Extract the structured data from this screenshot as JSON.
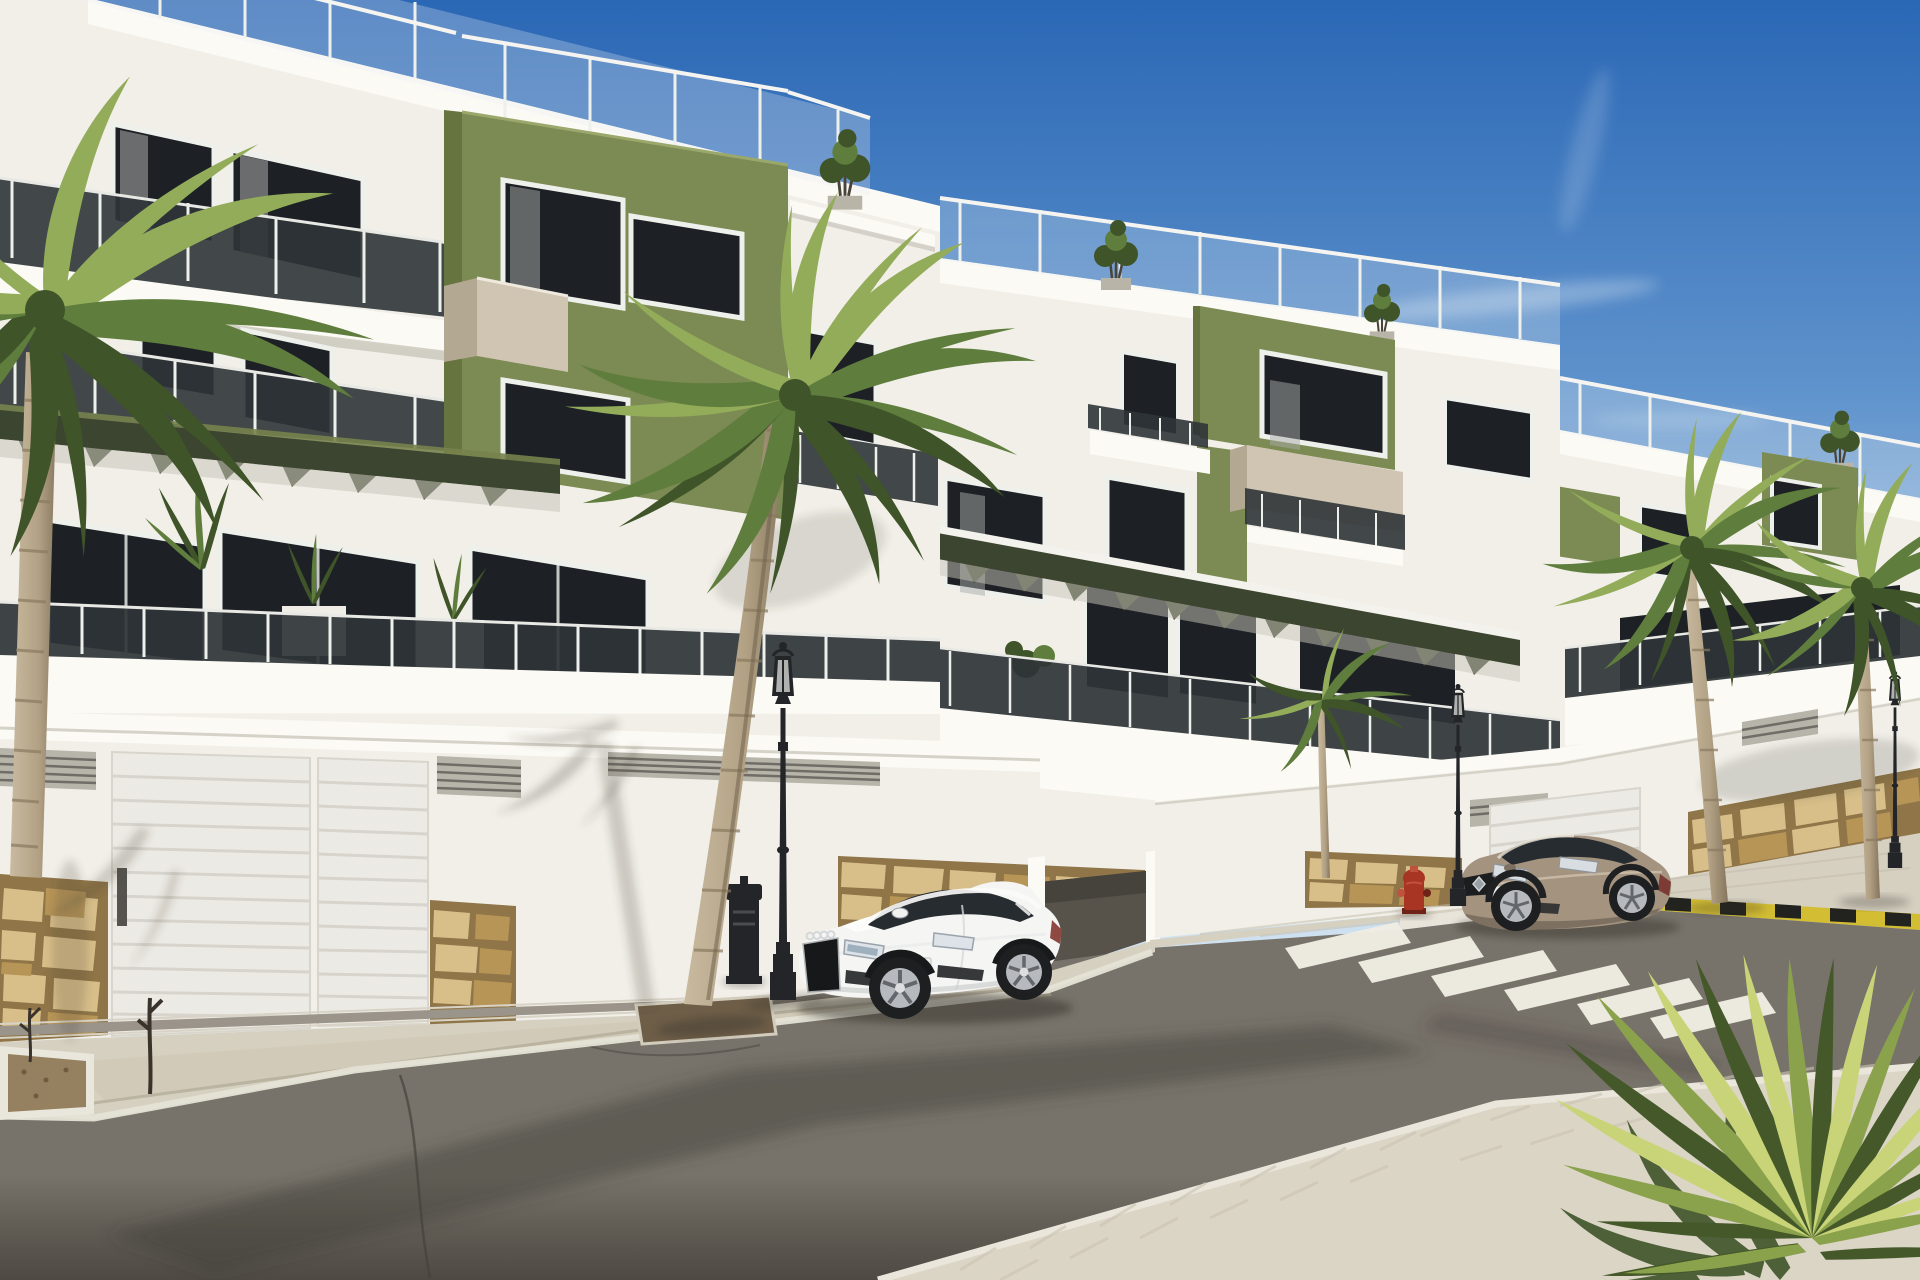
{
  "scene": {
    "type": "photorealistic-architectural-render",
    "description": "Modern white three-storey apartment complex with olive-green accent panels, smoked-glass balconies and roof terraces above a garage level; street in front with parked white coupe, bronze coupe at a zebra crossing, palm trees, classic street lamps and a foreground palmetto",
    "time_of_day": "sunny daytime, clear blue sky",
    "visible_text": "none legible (license plates blurred)"
  },
  "palette": {
    "sky_top": "#2a67b5",
    "sky_mid": "#6f9fd2",
    "sky_horizon": "#d9e8f4",
    "wall_white": "#f1efe8",
    "wall_bright": "#fbfaf5",
    "wall_shade": "#ddd9cf",
    "cornice_shadow": "#c9c5ba",
    "accent_olive": "#7c8a53",
    "accent_olive_dark": "#66743f",
    "accent_olive_light": "#8d9a60",
    "pergola_dark": "#3c452f",
    "pergola_slat": "#77824d",
    "glass_dark": "#1d2125",
    "glass_smoke": "#2f3437",
    "frame_white": "#eef0ec",
    "beige_box": "#cfc5b2",
    "beige_shade": "#b3a892",
    "stone_base": "#8f7547",
    "stone_light": "#d8bf8a",
    "stone_mid": "#b79557",
    "pave_light": "#d6d0c1",
    "pave_shade": "#c9bfa9",
    "curb_light": "#e5e1d6",
    "road_top": "#78736a",
    "road_bottom": "#4e4a43",
    "lamp_black": "#232528",
    "car_white": "#f5f5f3",
    "car_glass": "#272c31",
    "alloy_silver": "#b6babe",
    "renault_bronze": "#a3937f",
    "renault_shade": "#7e7060",
    "hydrant_red": "#a83524",
    "palm_green": "#5f7d3c",
    "palm_green_light": "#93ac5a",
    "palm_green_dark": "#3f5429",
    "trunk_light": "#c0b091",
    "yucca_light": "#c9d478",
    "yucca_mid": "#8ba24c",
    "yucca_dark": "#44582a",
    "hazard_yellow": "#d3bd33",
    "hazard_black": "#22231e"
  },
  "objects": {
    "buildings": [
      {
        "label": "left apartment block, 3 floors over garage, olive accent box, glass balustrades, roof terrace"
      },
      {
        "label": "middle apartment block, olive accent panels, beige balcony boxes, slatted pergola"
      },
      {
        "label": "right apartment block receding with olive panels and roof terrace"
      }
    ],
    "vehicles": [
      {
        "label": "white sports coupe parked at kerb",
        "color": "#f5f5f3"
      },
      {
        "label": "bronze coupe stopped by zebra crossing",
        "color": "#a3937f"
      }
    ],
    "street": {
      "crosswalk_stripes": 6,
      "hazard_curb": "yellow-black striped kerb on right median",
      "surfaces": [
        "asphalt road",
        "paved sidewalks",
        "stone-clad wall bases"
      ]
    },
    "furniture": {
      "street_lamps": 3,
      "litter_bin": 1,
      "fire_hydrant": 1,
      "planter_box": 1,
      "garage_doors": 2
    },
    "vegetation": {
      "palm_trees": 5,
      "foreground_palmetto": 1,
      "rooftop_shrubs": 3,
      "terrace_plants": "several"
    }
  }
}
